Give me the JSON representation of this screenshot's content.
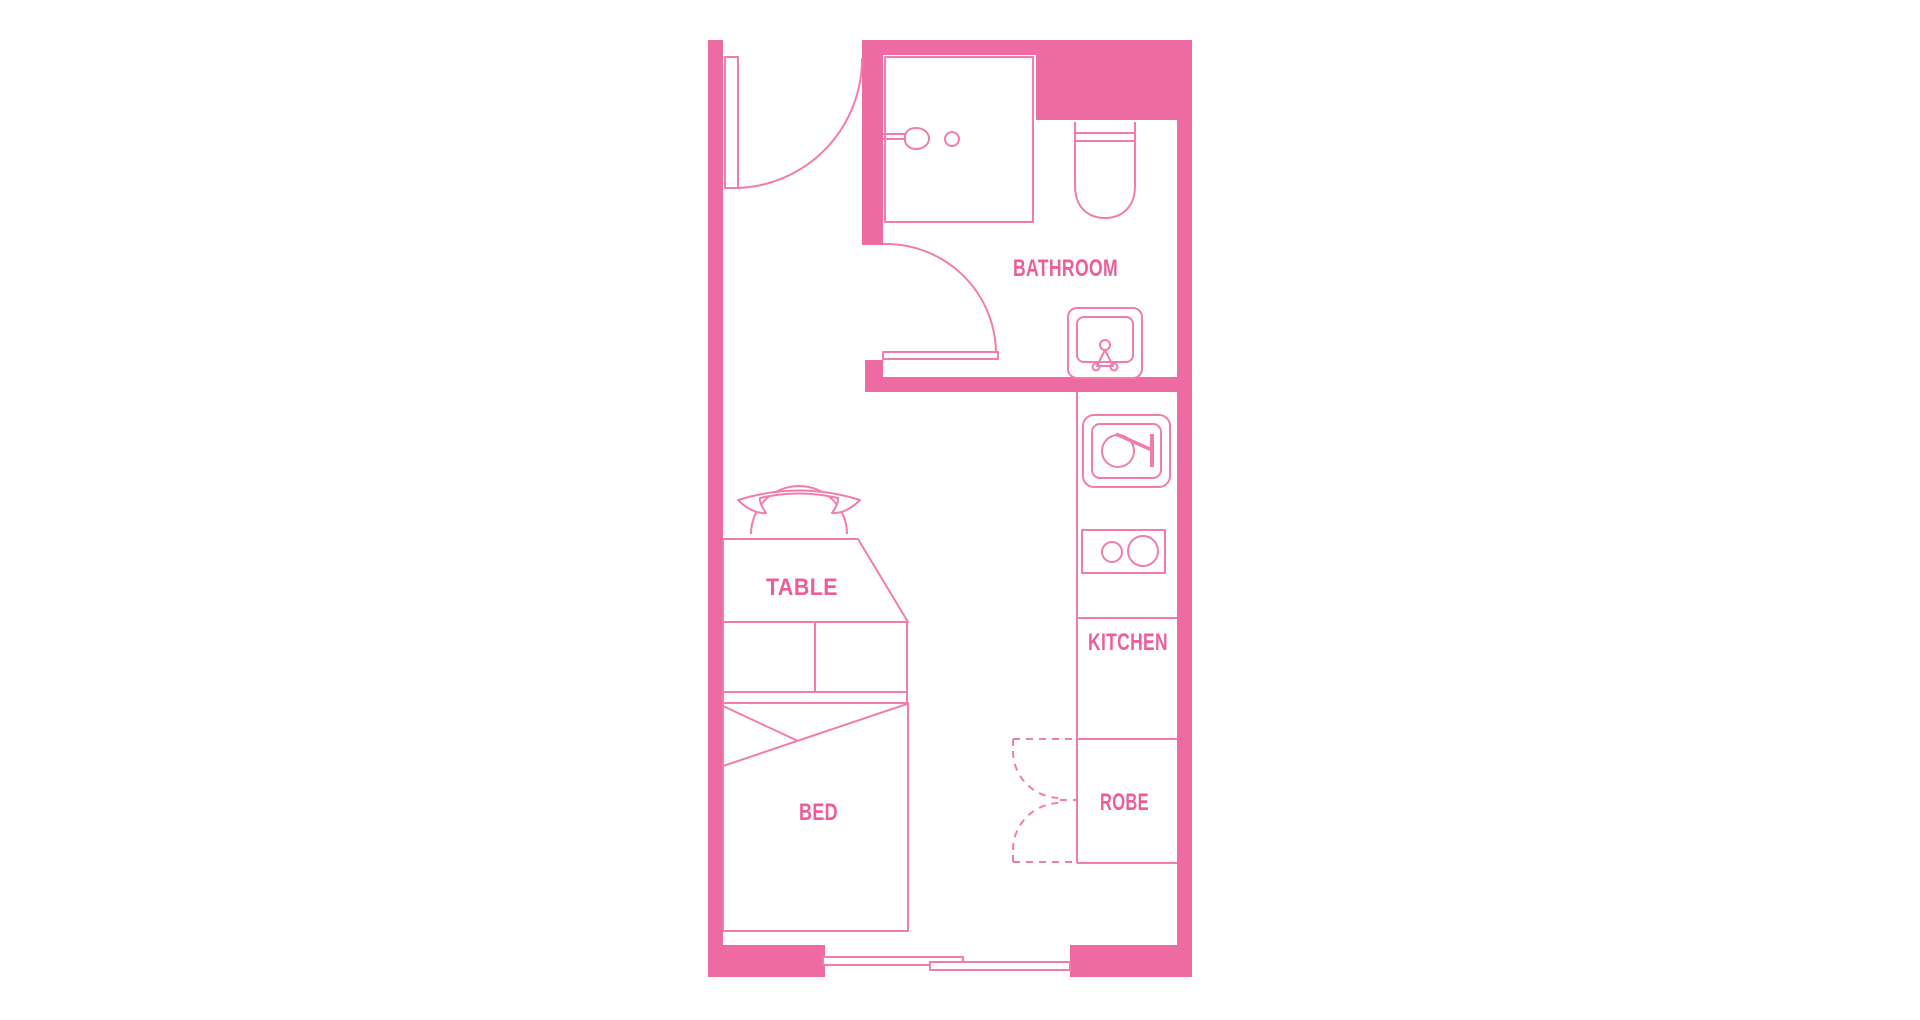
{
  "meta": {
    "type": "floor-plan",
    "description": "Studio apartment floor plan, pink line drawing on white"
  },
  "colors": {
    "wall": "#ee6aa3",
    "line": "#f27cae",
    "label": "#ed5d9a",
    "background": "#ffffff"
  },
  "rooms": {
    "bathroom": {
      "label": "BATHROOM"
    },
    "kitchen": {
      "label": "KITCHEN"
    },
    "robe": {
      "label": "ROBE"
    },
    "table": {
      "label": "TABLE"
    },
    "bed": {
      "label": "BED"
    }
  },
  "fixtures": {
    "entry": [
      "entry-door-icon"
    ],
    "bathroom": [
      "shower-icon",
      "shower-head-icon",
      "shower-mixer-icon",
      "toilet-icon",
      "basin-icon",
      "bathroom-door-icon"
    ],
    "kitchen": [
      "kitchen-sink-icon",
      "cooktop-icon",
      "counter-lines"
    ],
    "robe": [
      "bifold-doors-icon"
    ],
    "living": [
      "chair-icon",
      "table-icon",
      "drawers-icon",
      "bed-icon",
      "window-icon"
    ]
  }
}
